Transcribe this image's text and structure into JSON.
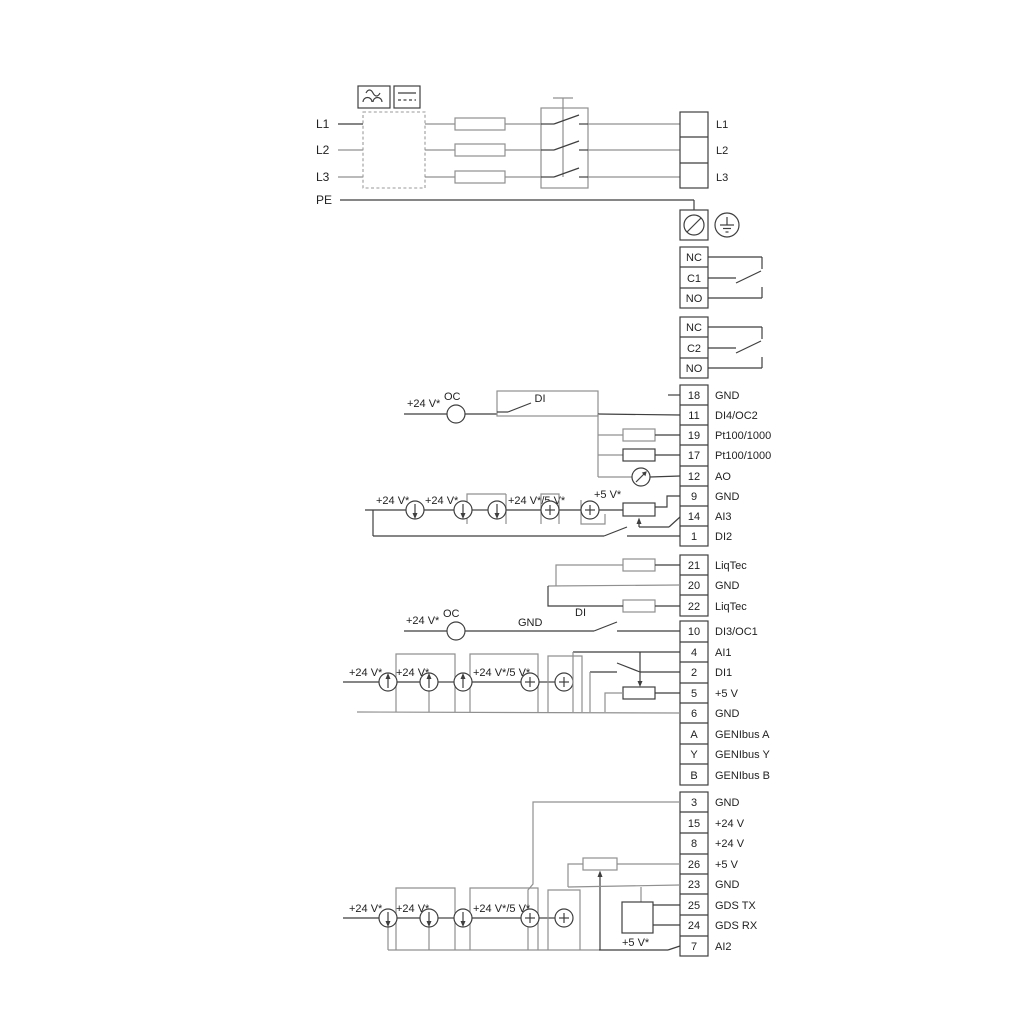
{
  "power": {
    "inputs": [
      "L1",
      "L2",
      "L3"
    ],
    "pe": "PE",
    "outputs": [
      "L1",
      "L2",
      "L3"
    ]
  },
  "relays": [
    {
      "terminals": [
        "NC",
        "C1",
        "NO"
      ]
    },
    {
      "terminals": [
        "NC",
        "C2",
        "NO"
      ]
    }
  ],
  "strips": {
    "a": [
      {
        "id": "18",
        "label": "GND"
      },
      {
        "id": "11",
        "label": "DI4/OC2"
      },
      {
        "id": "19",
        "label": "Pt100/1000"
      },
      {
        "id": "17",
        "label": "Pt100/1000"
      },
      {
        "id": "12",
        "label": "AO"
      },
      {
        "id": "9",
        "label": "GND"
      },
      {
        "id": "14",
        "label": "AI3"
      },
      {
        "id": "1",
        "label": "DI2"
      }
    ],
    "b": [
      {
        "id": "21",
        "label": "LiqTec"
      },
      {
        "id": "20",
        "label": "GND"
      },
      {
        "id": "22",
        "label": "LiqTec"
      }
    ],
    "c": [
      {
        "id": "10",
        "label": "DI3/OC1"
      },
      {
        "id": "4",
        "label": "AI1"
      },
      {
        "id": "2",
        "label": "DI1"
      },
      {
        "id": "5",
        "label": "+5 V"
      },
      {
        "id": "6",
        "label": "GND"
      },
      {
        "id": "A",
        "label": "GENIbus A"
      },
      {
        "id": "Y",
        "label": "GENIbus Y"
      },
      {
        "id": "B",
        "label": "GENIbus B"
      }
    ],
    "d": [
      {
        "id": "3",
        "label": "GND"
      },
      {
        "id": "15",
        "label": "+24 V"
      },
      {
        "id": "8",
        "label": "+24 V"
      },
      {
        "id": "26",
        "label": "+5 V"
      },
      {
        "id": "23",
        "label": "GND"
      },
      {
        "id": "25",
        "label": "GDS TX"
      },
      {
        "id": "24",
        "label": "GDS RX"
      },
      {
        "id": "7",
        "label": "AI2"
      }
    ]
  },
  "annotations": {
    "di4_v24": "+24 V*",
    "di4_oc": "OC",
    "di4_di": "DI",
    "ai3_v24a": "+24 V*",
    "ai3_v24b": "+24 V*",
    "ai3_v24_5v": "+24 V*/5 V*",
    "ai3_v5": "+5 V*",
    "di3_v24": "+24 V*",
    "di3_oc": "OC",
    "di3_gnd": "GND",
    "di3_di": "DI",
    "ai1_v24a": "+24 V*",
    "ai1_v24b": "+24 V*",
    "ai1_v24_5v": "+24 V*/5 V*",
    "ai2_v24a": "+24 V*",
    "ai2_v24b": "+24 V*",
    "ai2_v24_5v": "+24 V*/5 V*",
    "ai2_v5": "+5 V*"
  },
  "colors": {
    "wire_gray": "#909090",
    "wire_dark": "#3f3f3f",
    "text": "#222222"
  }
}
